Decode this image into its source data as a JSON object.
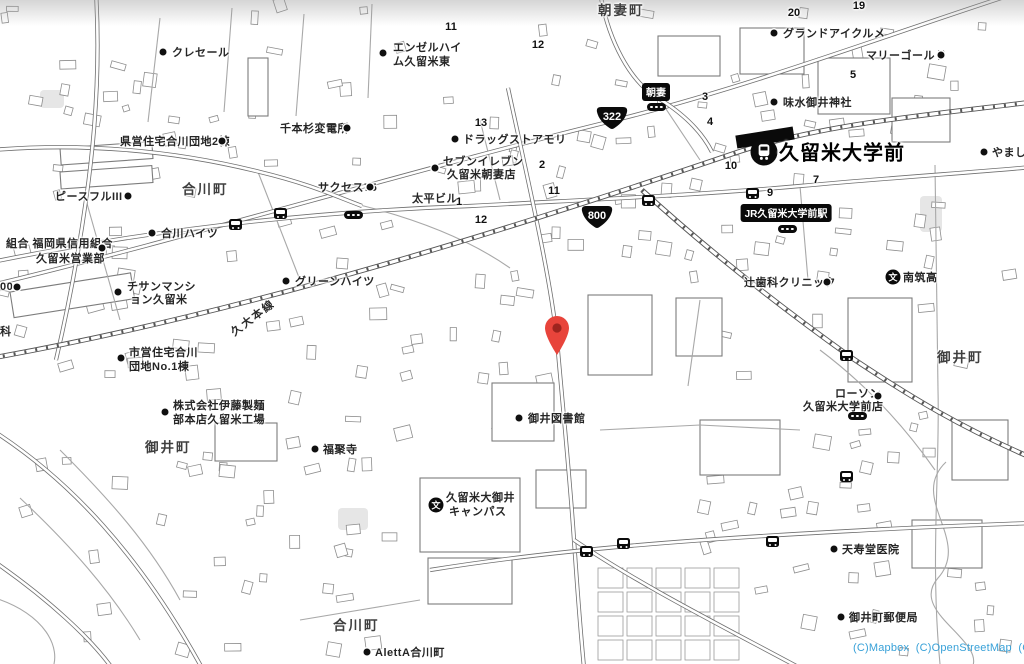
{
  "map": {
    "background": "#ffffff",
    "road_color": "#6f6f6f",
    "building_color": "#8d8d8d",
    "attribution": {
      "text": "(C)Mapbox  (C)OpenStreetMap  (C)LY",
      "color": "#38a1d8"
    },
    "pin": {
      "x": 557,
      "y": 355,
      "color": "#e8443b",
      "inner_color": "#9e241e"
    },
    "station": {
      "name": "久留米大学前",
      "name_x": 779,
      "name_y": 151,
      "icon_x": 764,
      "icon_y": 152,
      "platform": {
        "x": 736,
        "y": 131,
        "w": 58,
        "h": 13,
        "rotate": -9
      }
    },
    "badges": [
      {
        "text": "朝妻",
        "x": 656,
        "y": 92
      },
      {
        "text": "JR久留米大学前駅",
        "x": 786,
        "y": 213
      }
    ],
    "route_shields": [
      {
        "text": "322",
        "x": 612,
        "y": 119
      },
      {
        "text": "800",
        "x": 597,
        "y": 218
      }
    ],
    "railway_label": {
      "text": "久大本線",
      "x": 232,
      "y": 333,
      "rotate": -37
    },
    "area_labels": [
      {
        "text": "朝妻町",
        "x": 598,
        "y": 9
      },
      {
        "text": "合川町",
        "x": 182,
        "y": 188
      },
      {
        "text": "御井町",
        "x": 145,
        "y": 446
      },
      {
        "text": "御井町",
        "x": 937,
        "y": 356
      },
      {
        "text": "合川町",
        "x": 333,
        "y": 624
      }
    ],
    "poi_labels": [
      {
        "lines": [
          {
            "t": "クレセール",
            "x": 172,
            "y": 52
          }
        ],
        "dot": {
          "x": 163,
          "y": 52
        }
      },
      {
        "lines": [
          {
            "t": "エンゼルハイ",
            "x": 393,
            "y": 47
          },
          {
            "t": "ム久留米東",
            "x": 393,
            "y": 61
          }
        ],
        "dot": {
          "x": 383,
          "y": 53
        }
      },
      {
        "lines": [
          {
            "t": "グランドアイクルメ",
            "x": 783,
            "y": 33
          }
        ],
        "dot": {
          "x": 774,
          "y": 33
        }
      },
      {
        "lines": [
          {
            "t": "マリーゴールド",
            "x": 866,
            "y": 55
          }
        ],
        "dot": {
          "x": 941,
          "y": 55
        }
      },
      {
        "lines": [
          {
            "t": "やまし",
            "x": 992,
            "y": 152
          }
        ],
        "dot": {
          "x": 984,
          "y": 152
        }
      },
      {
        "lines": [
          {
            "t": "味水御井神社",
            "x": 783,
            "y": 102
          }
        ],
        "dot": {
          "x": 774,
          "y": 102
        }
      },
      {
        "lines": [
          {
            "t": "千本杉変電所",
            "x": 280,
            "y": 128
          }
        ],
        "dot": {
          "x": 347,
          "y": 128
        }
      },
      {
        "lines": [
          {
            "t": "県営住宅合川団地2棟",
            "x": 120,
            "y": 141
          }
        ],
        "dot": {
          "x": 222,
          "y": 141
        }
      },
      {
        "lines": [
          {
            "t": "ピースフルIII",
            "x": 55,
            "y": 196
          }
        ],
        "dot": {
          "x": 128,
          "y": 196
        }
      },
      {
        "lines": [
          {
            "t": "サクセス75",
            "x": 318,
            "y": 187
          }
        ],
        "dot": {
          "x": 370,
          "y": 187
        }
      },
      {
        "lines": [
          {
            "t": "合川ハイツ",
            "x": 161,
            "y": 233
          }
        ],
        "dot": {
          "x": 152,
          "y": 233
        }
      },
      {
        "lines": [
          {
            "t": "組合 福岡県信用組合",
            "x": 6,
            "y": 243
          },
          {
            "t": "久留米営業部",
            "x": 36,
            "y": 258
          }
        ],
        "dot": {
          "x": 102,
          "y": 248
        }
      },
      {
        "lines": [
          {
            "t": "00",
            "x": 0,
            "y": 287
          }
        ],
        "dot": {
          "x": 17,
          "y": 287
        }
      },
      {
        "lines": [
          {
            "t": "チサンマンシ",
            "x": 127,
            "y": 286
          },
          {
            "t": "ョン久留米",
            "x": 130,
            "y": 299
          }
        ],
        "dot": {
          "x": 118,
          "y": 292
        }
      },
      {
        "lines": [
          {
            "t": "グリーンハイツ",
            "x": 295,
            "y": 281
          }
        ],
        "dot": {
          "x": 286,
          "y": 281
        }
      },
      {
        "lines": [
          {
            "t": "科",
            "x": 0,
            "y": 331
          }
        ]
      },
      {
        "lines": [
          {
            "t": "市営住宅合川",
            "x": 129,
            "y": 352
          },
          {
            "t": "団地No.1棟",
            "x": 129,
            "y": 366
          }
        ],
        "dot": {
          "x": 121,
          "y": 358
        }
      },
      {
        "lines": [
          {
            "t": "株式会社伊藤製麺",
            "x": 173,
            "y": 405
          },
          {
            "t": "部本店久留米工場",
            "x": 173,
            "y": 419
          }
        ],
        "dot": {
          "x": 165,
          "y": 412
        }
      },
      {
        "lines": [
          {
            "t": "福聚寺",
            "x": 323,
            "y": 449
          }
        ],
        "dot": {
          "x": 315,
          "y": 449
        }
      },
      {
        "lines": [
          {
            "t": "辻歯科クリニック",
            "x": 744,
            "y": 282
          }
        ],
        "dot": {
          "x": 827,
          "y": 282
        }
      },
      {
        "lines": [
          {
            "t": "御井図書館",
            "x": 528,
            "y": 418
          }
        ],
        "dot": {
          "x": 519,
          "y": 418
        }
      },
      {
        "lines": [
          {
            "t": "ローソン",
            "x": 835,
            "y": 393
          },
          {
            "t": "久留米大学前店",
            "x": 803,
            "y": 406
          }
        ],
        "dot": {
          "x": 878,
          "y": 396
        }
      },
      {
        "lines": [
          {
            "t": "天寿堂医院",
            "x": 842,
            "y": 549
          }
        ],
        "dot": {
          "x": 834,
          "y": 549
        }
      },
      {
        "lines": [
          {
            "t": "御井町郵便局",
            "x": 849,
            "y": 617
          }
        ],
        "dot": {
          "x": 841,
          "y": 617
        }
      },
      {
        "lines": [
          {
            "t": "AlettA合川町",
            "x": 375,
            "y": 652
          }
        ],
        "dot": {
          "x": 367,
          "y": 652
        }
      },
      {
        "lines": [
          {
            "t": "ドラッグストアモリ",
            "x": 463,
            "y": 139
          }
        ],
        "dot": {
          "x": 455,
          "y": 139
        }
      },
      {
        "lines": [
          {
            "t": "セブンイレブン",
            "x": 443,
            "y": 161
          },
          {
            "t": "久留米朝妻店",
            "x": 447,
            "y": 174
          }
        ],
        "dot": {
          "x": 435,
          "y": 168
        }
      },
      {
        "lines": [
          {
            "t": "太平ビル",
            "x": 412,
            "y": 198
          }
        ]
      }
    ],
    "school_pois": [
      {
        "lines": [
          {
            "t": "久留米大御井",
            "x": 446,
            "y": 497
          },
          {
            "t": "キャンパス",
            "x": 449,
            "y": 511
          }
        ],
        "icon": {
          "x": 436,
          "y": 505,
          "glyph": "文"
        }
      },
      {
        "lines": [
          {
            "t": "南筑高",
            "x": 903,
            "y": 277
          }
        ],
        "icon": {
          "x": 893,
          "y": 277,
          "glyph": "文"
        }
      }
    ],
    "house_numbers": [
      {
        "t": "11",
        "x": 451,
        "y": 27
      },
      {
        "t": "12",
        "x": 538,
        "y": 45
      },
      {
        "t": "13",
        "x": 481,
        "y": 123
      },
      {
        "t": "19",
        "x": 859,
        "y": 6
      },
      {
        "t": "20",
        "x": 794,
        "y": 13
      },
      {
        "t": "5",
        "x": 853,
        "y": 75
      },
      {
        "t": "3",
        "x": 705,
        "y": 97
      },
      {
        "t": "4",
        "x": 710,
        "y": 122
      },
      {
        "t": "10",
        "x": 731,
        "y": 166
      },
      {
        "t": "9",
        "x": 770,
        "y": 193
      },
      {
        "t": "7",
        "x": 816,
        "y": 180
      },
      {
        "t": "2",
        "x": 542,
        "y": 165
      },
      {
        "t": "1",
        "x": 459,
        "y": 202
      },
      {
        "t": "11",
        "x": 554,
        "y": 191
      },
      {
        "t": "12",
        "x": 481,
        "y": 220
      }
    ],
    "bus_stop_squares": [
      {
        "x": 642,
        "y": 195
      },
      {
        "x": 274,
        "y": 208
      },
      {
        "x": 840,
        "y": 350
      },
      {
        "x": 580,
        "y": 546
      },
      {
        "x": 617,
        "y": 538
      },
      {
        "x": 766,
        "y": 536
      },
      {
        "x": 840,
        "y": 471
      },
      {
        "x": 229,
        "y": 219
      },
      {
        "x": 746,
        "y": 188
      }
    ],
    "bus_stop_pills": [
      {
        "x": 647,
        "y": 103
      },
      {
        "x": 778,
        "y": 225
      },
      {
        "x": 344,
        "y": 211
      },
      {
        "x": 848,
        "y": 412
      }
    ]
  }
}
